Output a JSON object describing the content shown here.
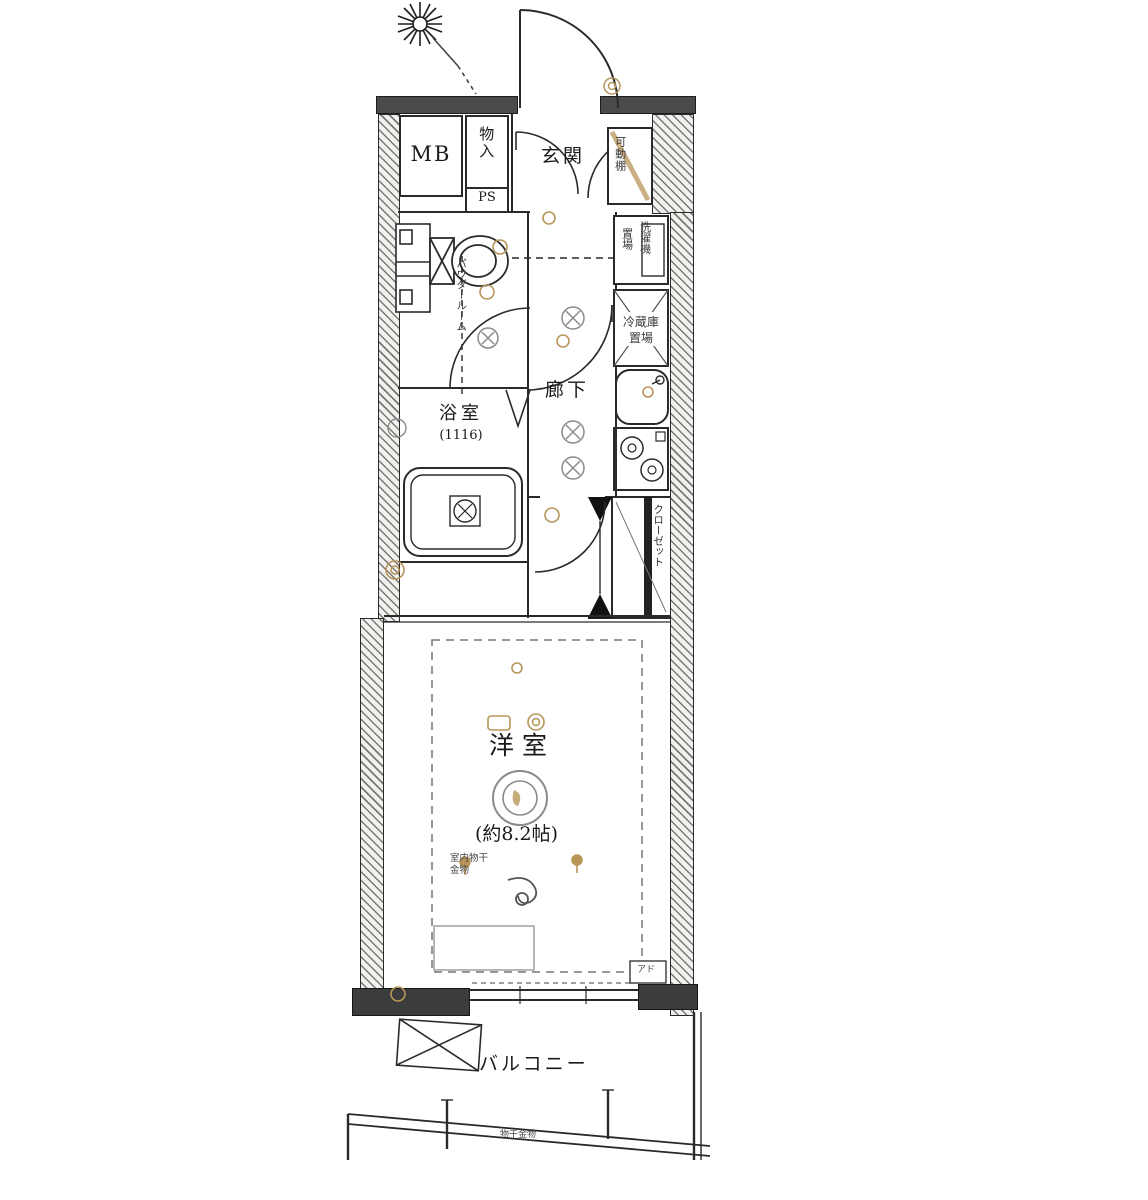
{
  "plan": {
    "type": "japanese-apartment-floor-plan",
    "colors": {
      "line": "#2a2a2a",
      "wall_fill": "#4a4a4a",
      "accent_beige": "#b8965a",
      "light_gray": "#8a8a8a",
      "background": "#ffffff"
    },
    "rooms": {
      "meter_box": {
        "label": "MB"
      },
      "pipe_space": {
        "label": "PS"
      },
      "storage": {
        "label": "物入"
      },
      "entrance": {
        "label": "玄関"
      },
      "movable_shelf": {
        "label": "可動棚"
      },
      "washer_place": {
        "line1": "洗濯機",
        "line2": "置場"
      },
      "fridge_place": {
        "line1": "冷蔵庫",
        "line2": "置場"
      },
      "powder_room": {
        "label": "パウダールーム"
      },
      "hallway": {
        "label": "廊下"
      },
      "bathroom": {
        "label": "浴室",
        "size": "(1116)"
      },
      "closet": {
        "label": "クローゼット"
      },
      "bedroom": {
        "label": "洋室",
        "size": "(約8.2帖)"
      },
      "balcony": {
        "label": "バルコニー"
      }
    },
    "annotations": {
      "indoor_drying_fixture": {
        "line1": "室内物干",
        "line2": "金物"
      },
      "balcony_drying_fixture": {
        "label": "物干金物"
      },
      "window_note": {
        "label": "アド"
      }
    },
    "icons": {
      "compass": "north-compass-star",
      "toilet": "toilet-symbol",
      "bathtub": "bathtub-symbol",
      "sink": "kitchen-sink-symbol",
      "stove": "two-burner-stove-symbol",
      "ceiling_light": "ceiling-light-symbol",
      "downlight": "downlight-symbol",
      "escape_hatch": "evacuation-hatch-x-box",
      "fridge_cross": "refrigerator-space-x-box",
      "hook": "indoor-drying-hook"
    }
  }
}
